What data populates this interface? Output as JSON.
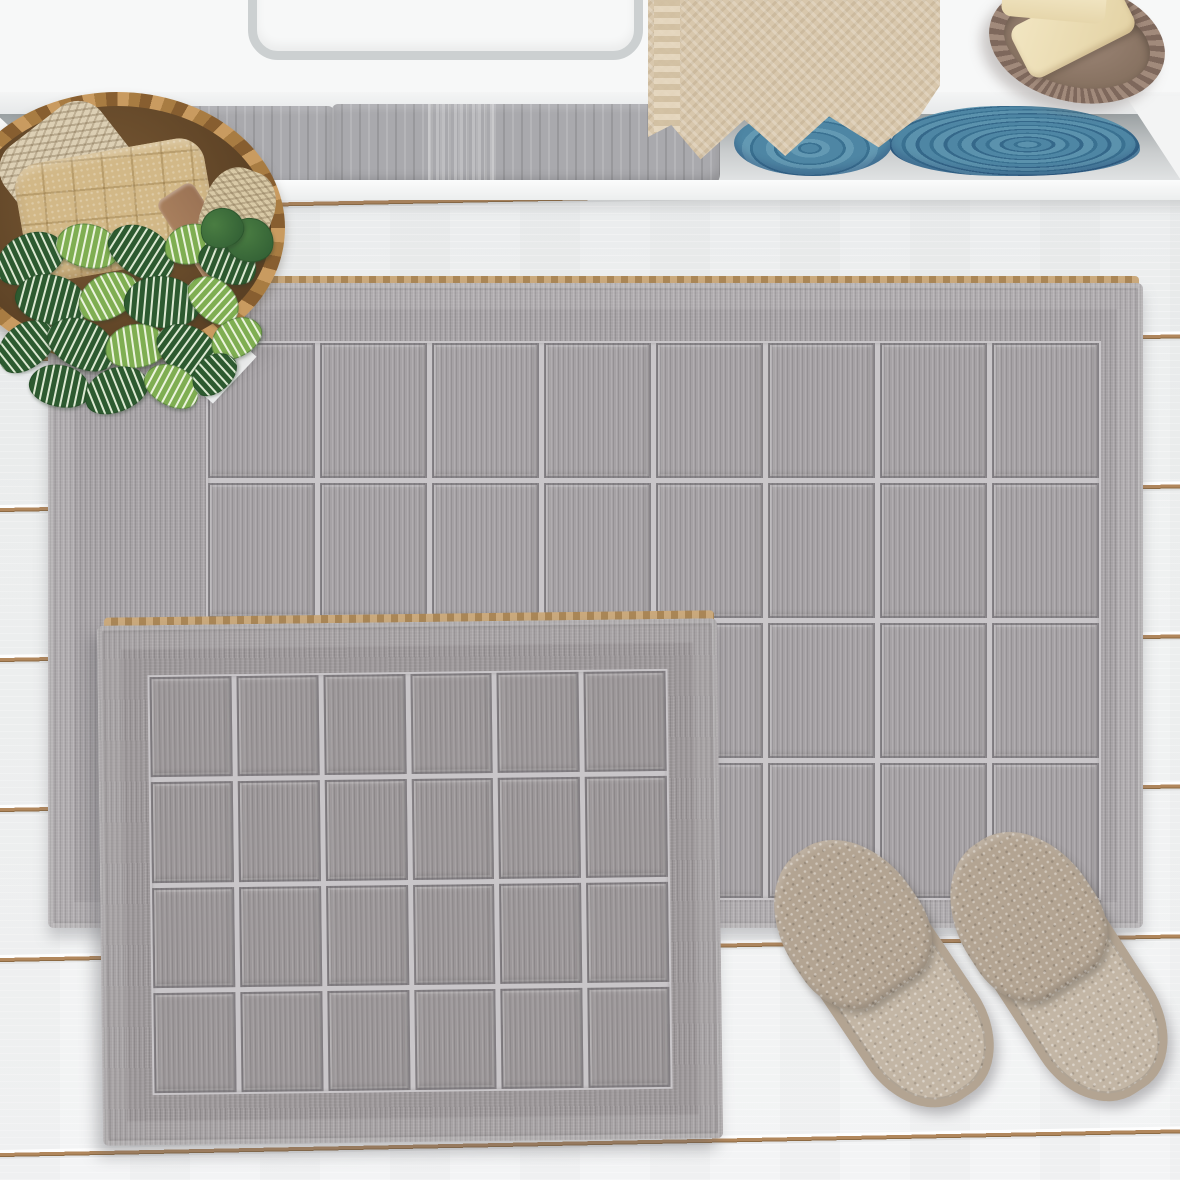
{
  "meta": {
    "alt": "Bathroom product photo: two-piece gray checkered cotton bath mat set on a white wooden plank floor, with a white shelf holding gray and blue towels, a hanging beige towel, a soap dish with soap bars, a wicker basket with rolled towels and a striped-leaf plant, and a pair of taupe slippers"
  },
  "palette": {
    "counter": "#f7f8f8",
    "floorA": "#e8eaeb",
    "floorB": "#f3f4f5",
    "gapline": "#b1875c",
    "matL": "#a6a2a5",
    "matS": "#9c9799",
    "gridline": "#c9c6c9",
    "jute": "#ab8757",
    "tgray": "#a9a9ad",
    "tbeige": "#d8c7ac",
    "tblue": "#4e86a4",
    "tblued": "#3a7191",
    "leafd": "#2d5a30",
    "leafl": "#7fae52",
    "leafs": "#dce9d2",
    "slip": "#b3a492",
    "slipl": "#c3b6a5",
    "dish": "#a18a7b",
    "dishd": "#7e685c",
    "soap": "#e3d2a4",
    "wood": "#9b7355",
    "wick": "#a87c42",
    "wickD": "#875e30",
    "wickL": "#c99b60"
  },
  "floor": {
    "gap_tops": [
      193,
      343,
      493,
      643,
      793,
      943,
      1138
    ],
    "tilt_deg": -1.15
  },
  "mats": {
    "large": {
      "cols": 8,
      "rows": 4
    },
    "small": {
      "cols": 6,
      "rows": 4
    }
  },
  "plant": {
    "leaves": [
      [
        30,
        258,
        72,
        48,
        -25,
        "dark"
      ],
      [
        88,
        246,
        64,
        44,
        12,
        "light"
      ],
      [
        142,
        252,
        72,
        48,
        32,
        "dark"
      ],
      [
        192,
        244,
        56,
        40,
        -12,
        "light"
      ],
      [
        228,
        262,
        60,
        42,
        22,
        "dark"
      ],
      [
        52,
        300,
        74,
        50,
        15,
        "dark"
      ],
      [
        108,
        296,
        64,
        44,
        -28,
        "light"
      ],
      [
        162,
        302,
        76,
        52,
        5,
        "dark"
      ],
      [
        214,
        300,
        58,
        40,
        42,
        "light"
      ],
      [
        26,
        346,
        64,
        44,
        -38,
        "dark"
      ],
      [
        82,
        344,
        72,
        48,
        26,
        "dark"
      ],
      [
        136,
        346,
        62,
        44,
        -8,
        "light"
      ],
      [
        190,
        352,
        72,
        48,
        36,
        "dark"
      ],
      [
        236,
        338,
        54,
        38,
        -30,
        "light"
      ],
      [
        60,
        386,
        62,
        42,
        12,
        "dark"
      ],
      [
        116,
        390,
        66,
        44,
        -22,
        "dark"
      ],
      [
        172,
        386,
        58,
        40,
        28,
        "light"
      ],
      [
        214,
        374,
        50,
        36,
        -42,
        "dark"
      ],
      [
        250,
        240,
        48,
        44,
        10,
        "plain"
      ],
      [
        222,
        228,
        44,
        40,
        -18,
        "plain"
      ]
    ]
  }
}
